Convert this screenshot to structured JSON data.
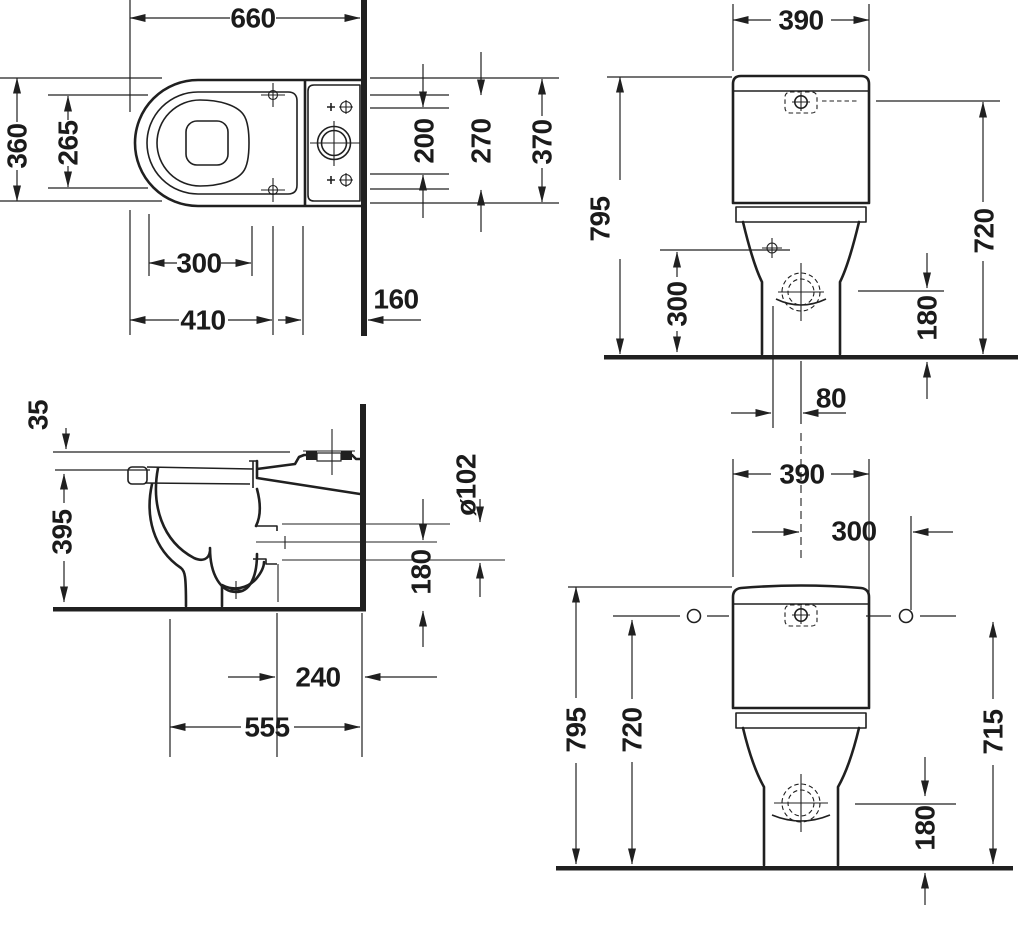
{
  "drawing_type": "sanitary technical dimension drawing",
  "colors": {
    "ink": "#1f1f1f",
    "paper": "#ffffff"
  },
  "views": {
    "plan": {
      "dims": {
        "total_depth": "660",
        "overall_width": "360",
        "seat_hole_spacing": "265",
        "hole_spacing": "300",
        "front_to_holes": "410",
        "behind_wall": "160",
        "tank_a": "200",
        "tank_b": "270",
        "tank_c": "370"
      }
    },
    "front_upper": {
      "dims": {
        "tank_width": "390",
        "overall_height": "795",
        "tank_top_height": "720",
        "supply_height": "300",
        "outlet_height": "180",
        "outlet_offset": "80"
      }
    },
    "side": {
      "dims": {
        "seat_thickness": "35",
        "rim_height": "395",
        "outlet_diameter": "ø102",
        "outlet_center_height": "180",
        "outlet_to_wall": "240",
        "depth_to_wall": "555"
      }
    },
    "front_lower": {
      "dims": {
        "tank_width": "390",
        "center_to_hole": "300",
        "overall_height": "795",
        "hole_height_left": "720",
        "hole_height_right": "715",
        "outlet_height": "180"
      }
    }
  }
}
